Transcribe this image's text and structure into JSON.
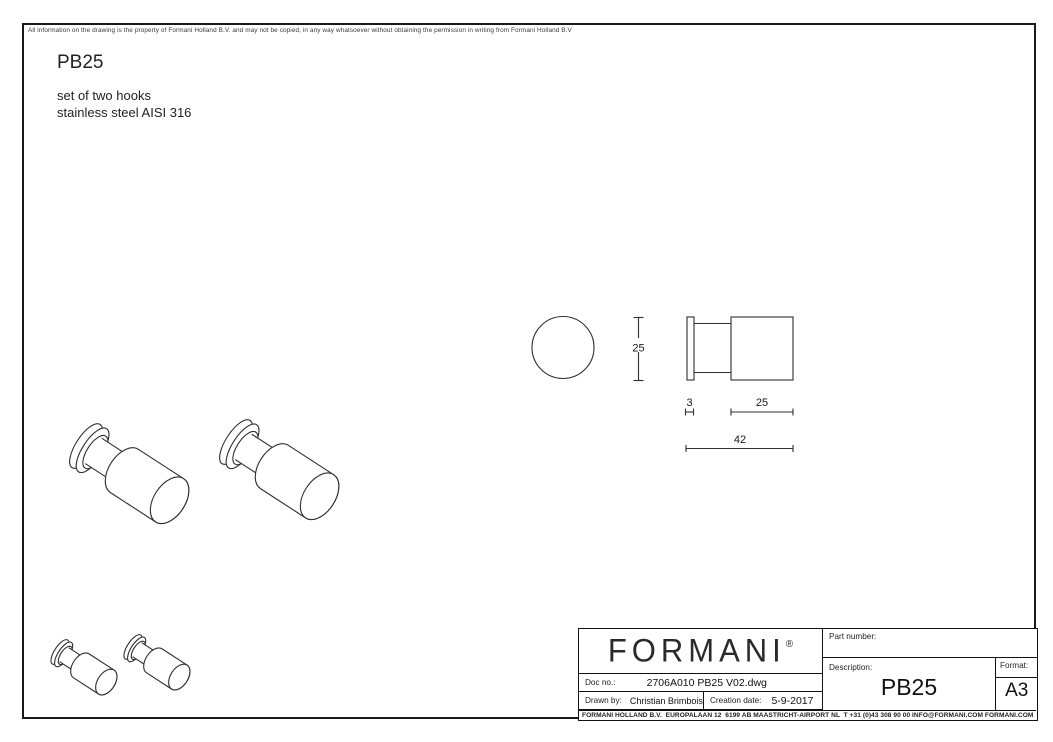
{
  "page": {
    "disclaimer": "All information on the drawing is the property of Formani Holland B.V. and may not be copied, in any way whatsoever without obtaining the permission in writing from Formani Holland B.V",
    "title": "PB25",
    "subtitle_line1": "set of two hooks",
    "subtitle_line2": "stainless steel AISI 316"
  },
  "drawing": {
    "dim_diameter": "25",
    "dim_flange_thickness": "3",
    "dim_cylinder_length": "25",
    "dim_total_length": "42"
  },
  "title_block": {
    "logo": "FORMANI",
    "logo_mark": "®",
    "doc_no_label": "Doc no.:",
    "doc_no_value": "2706A010 PB25 V02.dwg",
    "drawn_by_label": "Drawn by:",
    "drawn_by_value": "Christian Brimbois",
    "creation_date_label": "Creation date:",
    "creation_date_value": "5-9-2017",
    "part_number_label": "Part number:",
    "description_label": "Description:",
    "description_value": "PB25",
    "format_label": "Format:",
    "format_value": "A3",
    "footer": "FORMANI HOLLAND B.V.  EUROPALAAN 12  6199 AB MAASTRICHT-AIRPORT NL  T +31 (0)43 308 90 00 INFO@FORMANI.COM FORMANI.COM"
  },
  "colors": {
    "line": "#2f2f2f",
    "text": "#1a1a1a",
    "background": "#ffffff"
  }
}
